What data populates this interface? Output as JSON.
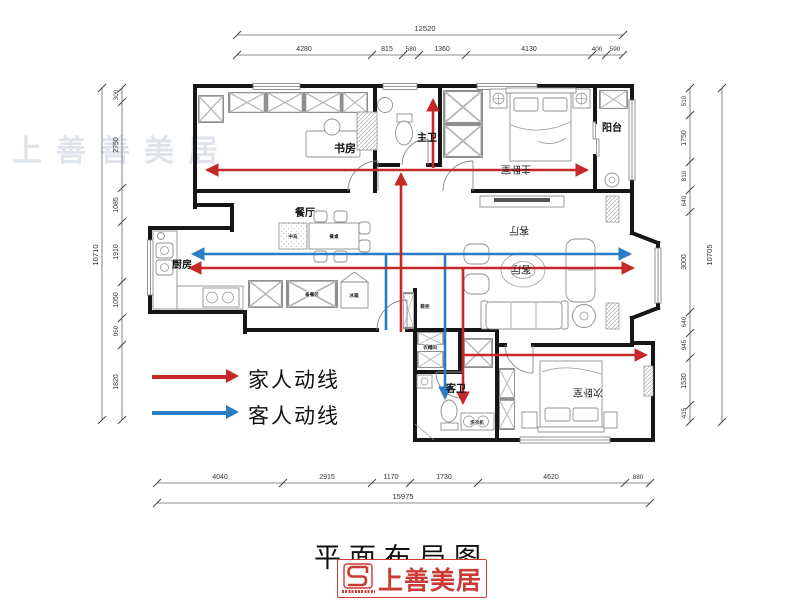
{
  "title": "平面布局图",
  "logo": {
    "name": "上善美居"
  },
  "watermark": "上善善美居",
  "legend": [
    {
      "label": "家人动线",
      "color": "#c62828"
    },
    {
      "label": "客人动线",
      "color": "#2b7bc5"
    }
  ],
  "rooms": {
    "study": "书房",
    "master_bath": "主卫",
    "master_bedroom": "主卧室",
    "balcony": "阳台",
    "dining": "餐厅",
    "kitchen": "厨房",
    "living": "客厅",
    "living_small": "客厅",
    "second_bedroom": "次卧室",
    "guest_bath": "客卫",
    "cloakroom": "衣帽间"
  },
  "labels": {
    "island": "中岛",
    "dining_table": "餐桌",
    "prep_area": "备餐区",
    "fridge": "冰箱",
    "washer": "洗衣机",
    "shoe_cabinet": "鞋柜"
  },
  "dimensions": {
    "top": {
      "total": "12520",
      "segments": [
        "4280",
        "815",
        "580",
        "1360",
        "4130",
        "400",
        "590"
      ]
    },
    "bottom": {
      "total": "15975",
      "segments": [
        "4040",
        "2915",
        "1170",
        "1730",
        "4620",
        "880"
      ]
    },
    "left": {
      "total": "10710",
      "segments": [
        "300",
        "2750",
        "1085",
        "1910",
        "1050",
        "950",
        "1820"
      ]
    },
    "right": {
      "total": "10705",
      "segments": [
        "510",
        "1750",
        "810",
        "640",
        "3000",
        "640",
        "945",
        "1530",
        "415"
      ]
    }
  }
}
